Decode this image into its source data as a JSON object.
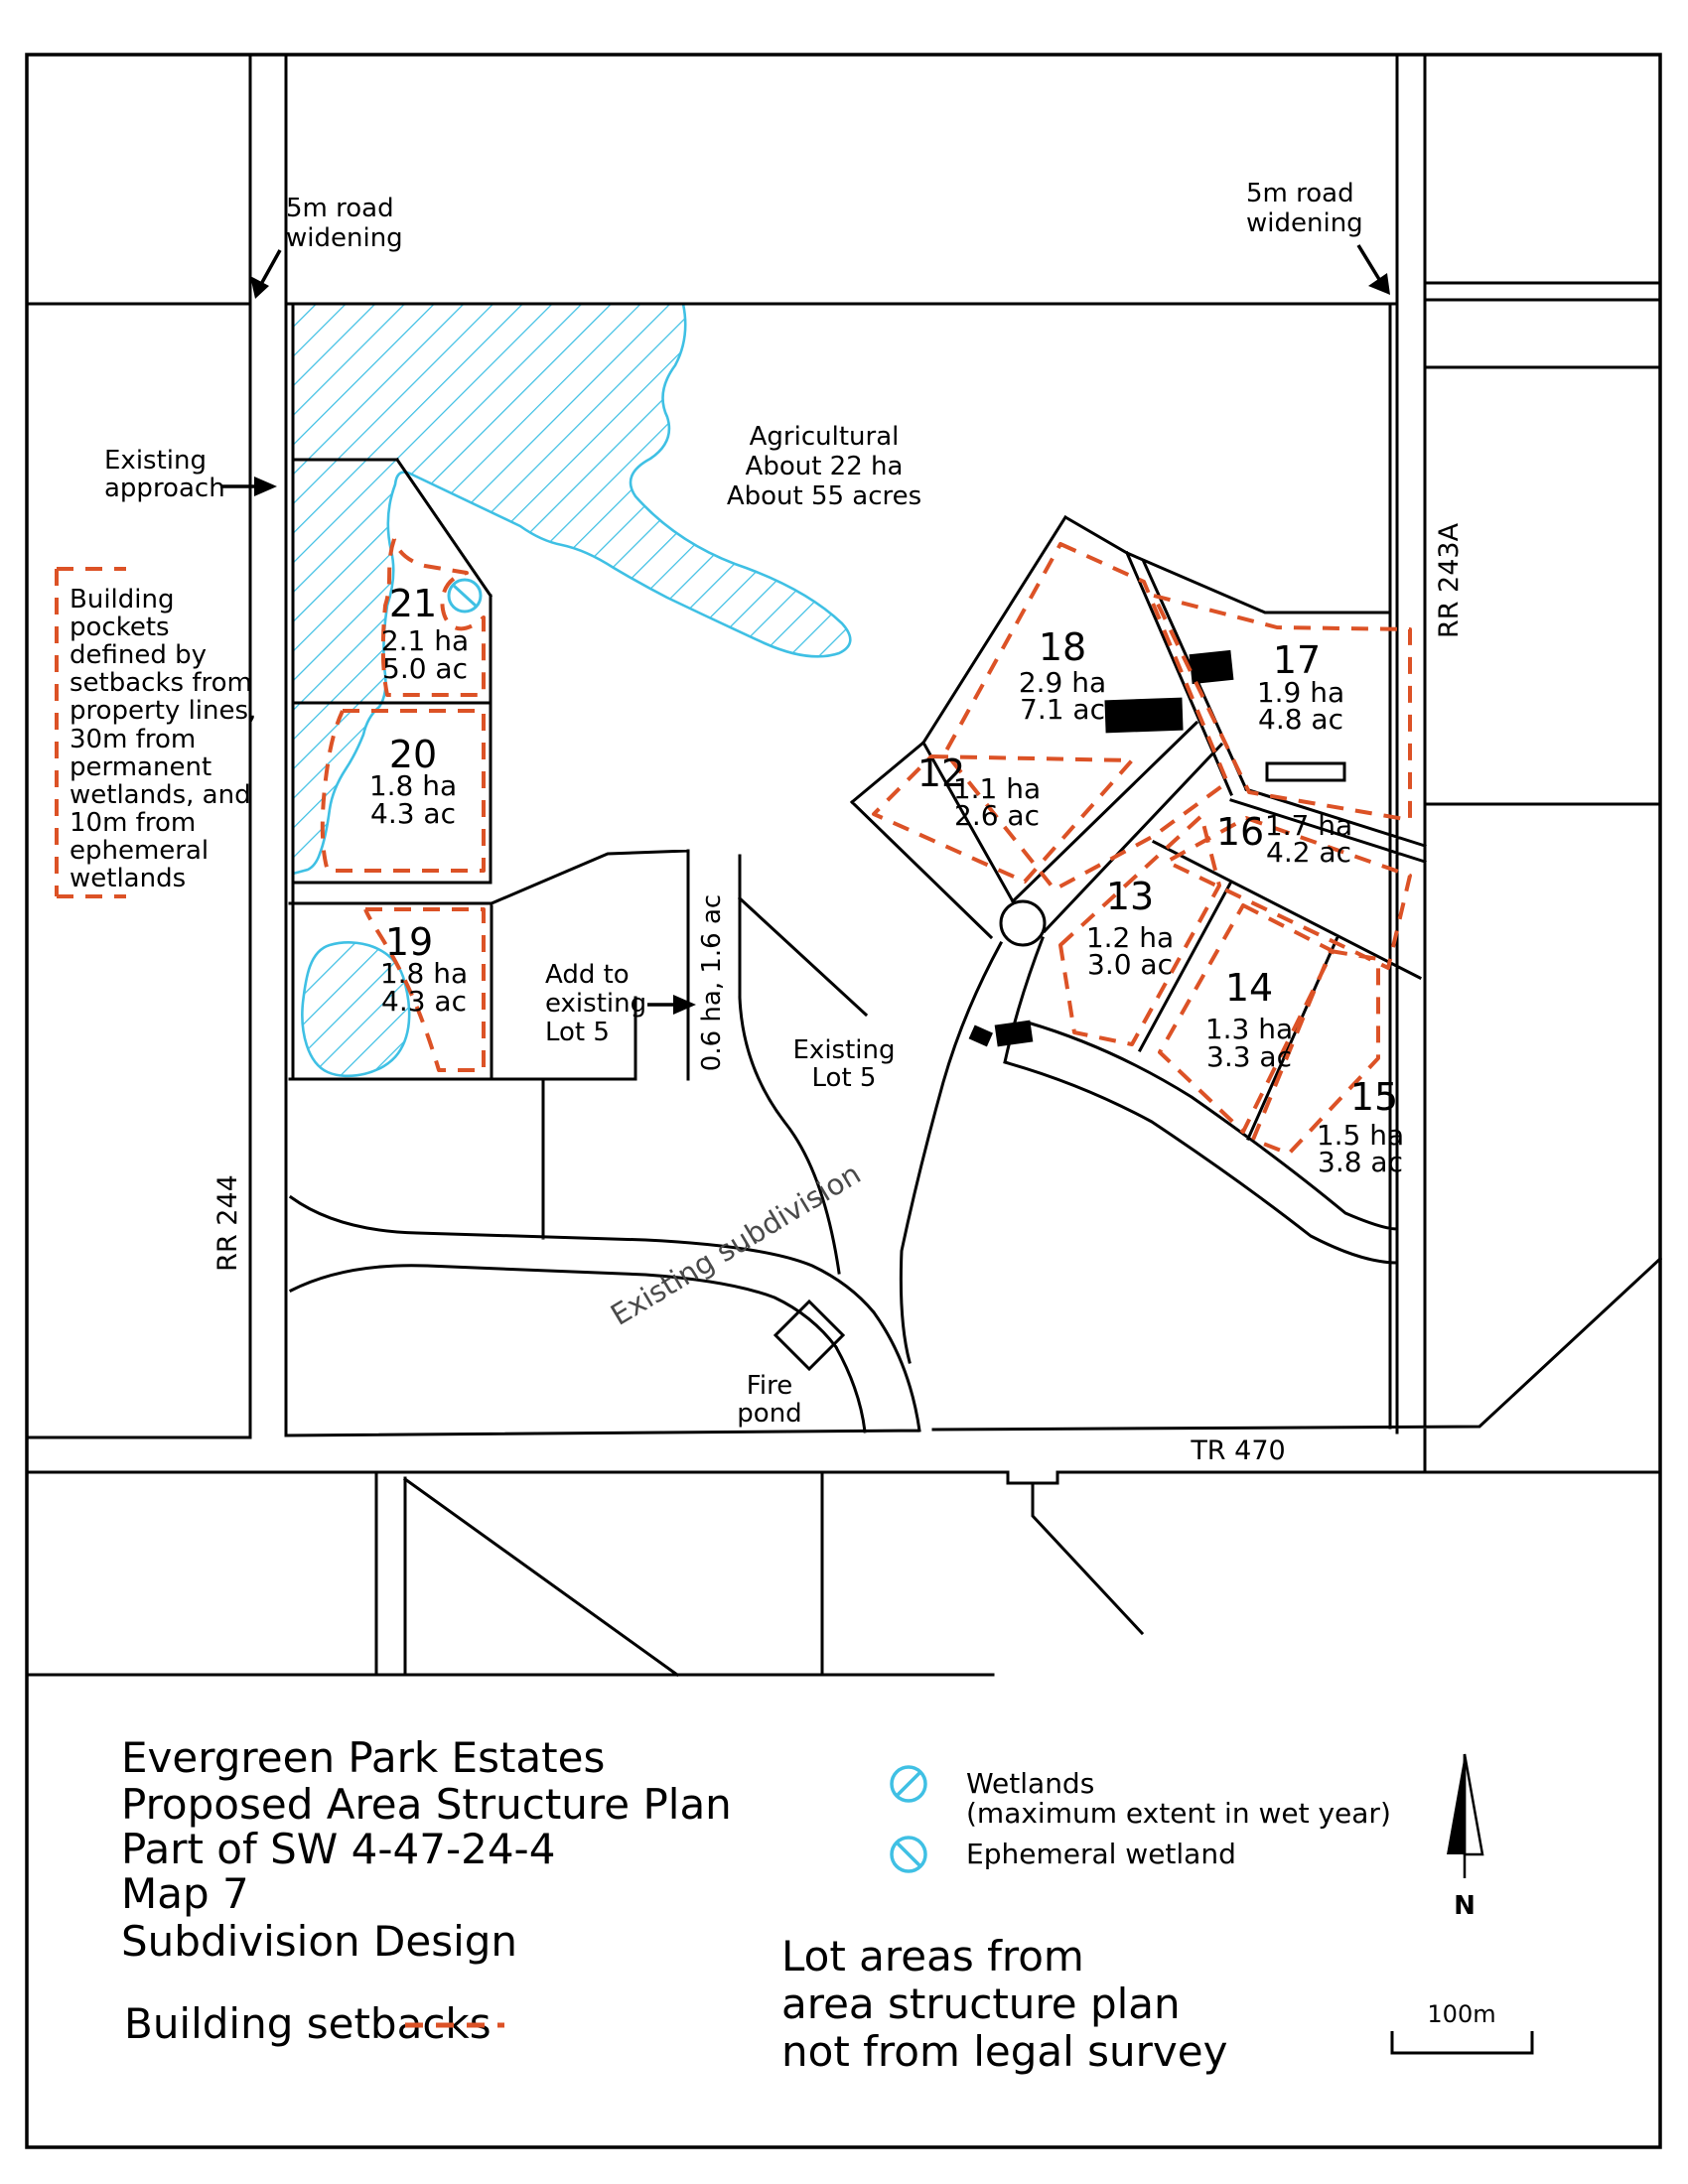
{
  "map": {
    "annotations": {
      "road_widening_left": [
        "5m road",
        "widening"
      ],
      "road_widening_right": [
        "5m road",
        "widening"
      ],
      "existing_approach": [
        "Existing",
        "approach"
      ],
      "building_pockets_note": [
        "Building",
        "pockets",
        "defined by",
        "setbacks from",
        "property lines,",
        "30m from",
        "permanent",
        "wetlands, and",
        "10m from",
        "ephemeral",
        "wetlands"
      ],
      "agricultural": [
        "Agricultural",
        "About 22 ha",
        "About 55 acres"
      ],
      "add_to_lot5": [
        "Add to",
        "existing",
        "Lot 5"
      ],
      "lot5_strip_area": "0.6 ha, 1.6 ac",
      "existing_lot5": [
        "Existing",
        "Lot 5"
      ],
      "existing_subdivision": "Existing subdivision",
      "fire_pond": [
        "Fire",
        "pond"
      ]
    },
    "roads": {
      "rr244": "RR 244",
      "rr243a": "RR 243A",
      "tr470": "TR 470"
    },
    "lots": [
      {
        "num": "21",
        "ha": "2.1 ha",
        "ac": "5.0 ac"
      },
      {
        "num": "20",
        "ha": "1.8 ha",
        "ac": "4.3 ac"
      },
      {
        "num": "19",
        "ha": "1.8 ha",
        "ac": "4.3 ac"
      },
      {
        "num": "18",
        "ha": "2.9 ha",
        "ac": "7.1 ac"
      },
      {
        "num": "17",
        "ha": "1.9 ha",
        "ac": "4.8 ac"
      },
      {
        "num": "12",
        "ha": "1.1 ha",
        "ac": "2.6 ac"
      },
      {
        "num": "16",
        "ha": "1.7 ha",
        "ac": "4.2 ac"
      },
      {
        "num": "13",
        "ha": "1.2 ha",
        "ac": "3.0 ac"
      },
      {
        "num": "14",
        "ha": "1.3 ha",
        "ac": "3.3 ac"
      },
      {
        "num": "15",
        "ha": "1.5 ha",
        "ac": "3.8 ac"
      }
    ]
  },
  "title_block": {
    "lines": [
      "Evergreen Park Estates",
      "Proposed Area Structure Plan",
      "Part of SW 4-47-24-4",
      "Map 7",
      "Subdivision Design"
    ],
    "building_setbacks_label": "Building setbacks"
  },
  "legend": {
    "wetlands_line1": "Wetlands",
    "wetlands_line2": "(maximum extent in wet year)",
    "ephemeral": "Ephemeral wetland"
  },
  "notes": {
    "lot_areas": [
      "Lot areas from",
      "area structure plan",
      "not from legal survey"
    ]
  },
  "compass": {
    "north": "N"
  },
  "scale": {
    "label": "100m"
  },
  "colors": {
    "setback_dash": "#DC5226",
    "wetland": "#3FC0E4",
    "line": "#000000",
    "subdivision_text": "#4A4A4A"
  }
}
